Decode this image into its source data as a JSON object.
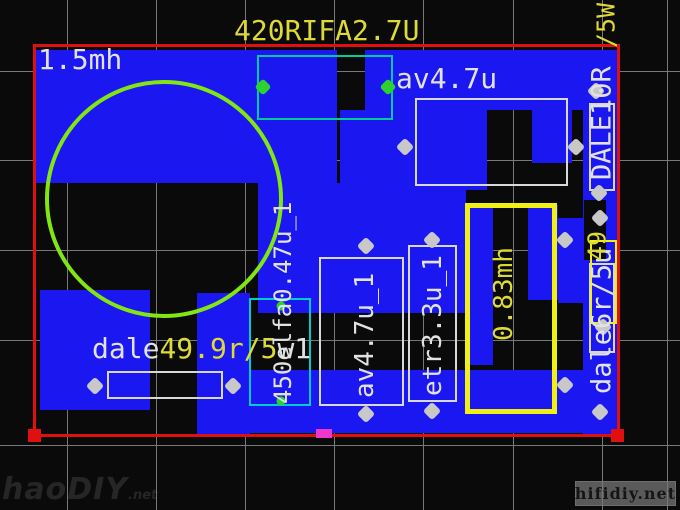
{
  "window": {
    "type": "pcb-layout-editor-view"
  },
  "colors": {
    "copper": "#1a17f0",
    "board_outline": "#e01010",
    "silkscreen_text": "#e2e2e2",
    "value_text": "#ddda38",
    "inductor_ring": "#82e612",
    "grid": "#787878",
    "pad_gray": "#c8c8c8",
    "pad_green": "#2ed22e",
    "box_cyan": "#00cccc",
    "box_teal": "#00cc99",
    "box_yellow": "#f0f014",
    "marker_magenta": "#ee35cc"
  },
  "labels": {
    "board_title": "420RIFA2.7U",
    "inductor_top_left": "1.5mh",
    "capacitor_top_right": "av4.7u",
    "resistor_white_prefix": "dale",
    "resistor_yellow_value": "49.9r/5",
    "resistor_white_suffix": "w1"
  },
  "vertical_labels": [
    {
      "name": "cap-450elfa",
      "text": "450elfa0.47u_1",
      "color": "white"
    },
    {
      "name": "cap-av47u-1",
      "text": "av4.7u_1",
      "color": "white"
    },
    {
      "name": "cap-etr33u-1",
      "text": "etr3.3u_1",
      "color": "white"
    },
    {
      "name": "inductor-083mh",
      "text": "0.83mh",
      "color": "yellow"
    },
    {
      "name": "resistor-dale6r",
      "text": "dale6r/5u",
      "color": "white"
    },
    {
      "name": "resistor-dale10r",
      "text": "DALE10R",
      "color": "white"
    },
    {
      "name": "resistor-dale10r-sfx",
      "text": "/5W",
      "color": "yellow"
    },
    {
      "name": "value-49-fragment",
      "text": "49",
      "color": "yellow"
    }
  ],
  "watermarks": {
    "bottom_left_main": "haoDIY",
    "bottom_left_suffix": ".net",
    "bottom_right": "hifidiy.net"
  }
}
